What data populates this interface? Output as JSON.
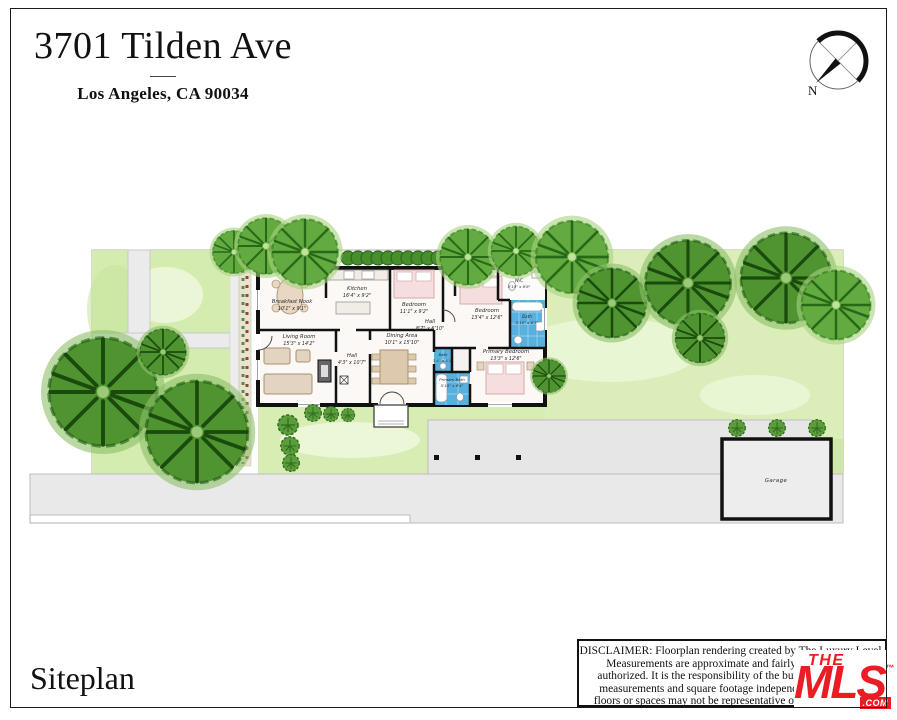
{
  "header": {
    "title": "3701 Tilden Ave",
    "subtitle": "Los Angeles, CA 90034"
  },
  "compass": {
    "north_label": "N"
  },
  "footer": {
    "label": "Siteplan"
  },
  "siteplan": {
    "garage_label": "Garage",
    "rooms": [
      {
        "name": "Breakfast Nook",
        "dims": "10'1\" x 9'1\""
      },
      {
        "name": "Kitchen",
        "dims": "16'4\" x 9'2\""
      },
      {
        "name": "Bedroom",
        "dims": "11'1\" x 9'2\""
      },
      {
        "name": "Hall",
        "dims": "8'7\" x 6'10\""
      },
      {
        "name": "Bedroom",
        "dims": "13'4\" x 12'6\""
      },
      {
        "name": "W/C",
        "dims": "3'10\" x 6'8\""
      },
      {
        "name": "Bath",
        "dims": "5'10\" x 6'7\""
      },
      {
        "name": "Living Room",
        "dims": "15'3\" x 14'2\""
      },
      {
        "name": "Dining Area",
        "dims": "10'1\" x 15'10\""
      },
      {
        "name": "Hall",
        "dims": "4'3\" x 10'7\""
      },
      {
        "name": "Bath",
        "dims": "3'6\" x 5'5\""
      },
      {
        "name": "Primary Bath",
        "dims": "5'10\" x 8'4\""
      },
      {
        "name": "Primary Bedroom",
        "dims": "13'3\" x 12'6\""
      }
    ]
  },
  "disclaimer": {
    "line1": "DISCLAIMER: Floorplan rendering created by The Luxury Level.",
    "line2": "Measurements are approximate and fairly exact but not",
    "line3": "authorized. It is the responsibility of the buyer to verify the",
    "line4": "measurements and square footage independently. Multiple",
    "line5": "floors or spaces may not be representative of actual location."
  },
  "logo": {
    "the": "THE",
    "mls": "MLS",
    "tm": "™",
    "com": ".COM"
  },
  "colors": {
    "accent_red": "#ec1c24",
    "lawn_green": "#d9edb7",
    "tree_green_light": "#63ab40",
    "tree_green_dark": "#4f9430",
    "bath_blue": "#58b0df",
    "wall_black": "#111111"
  }
}
